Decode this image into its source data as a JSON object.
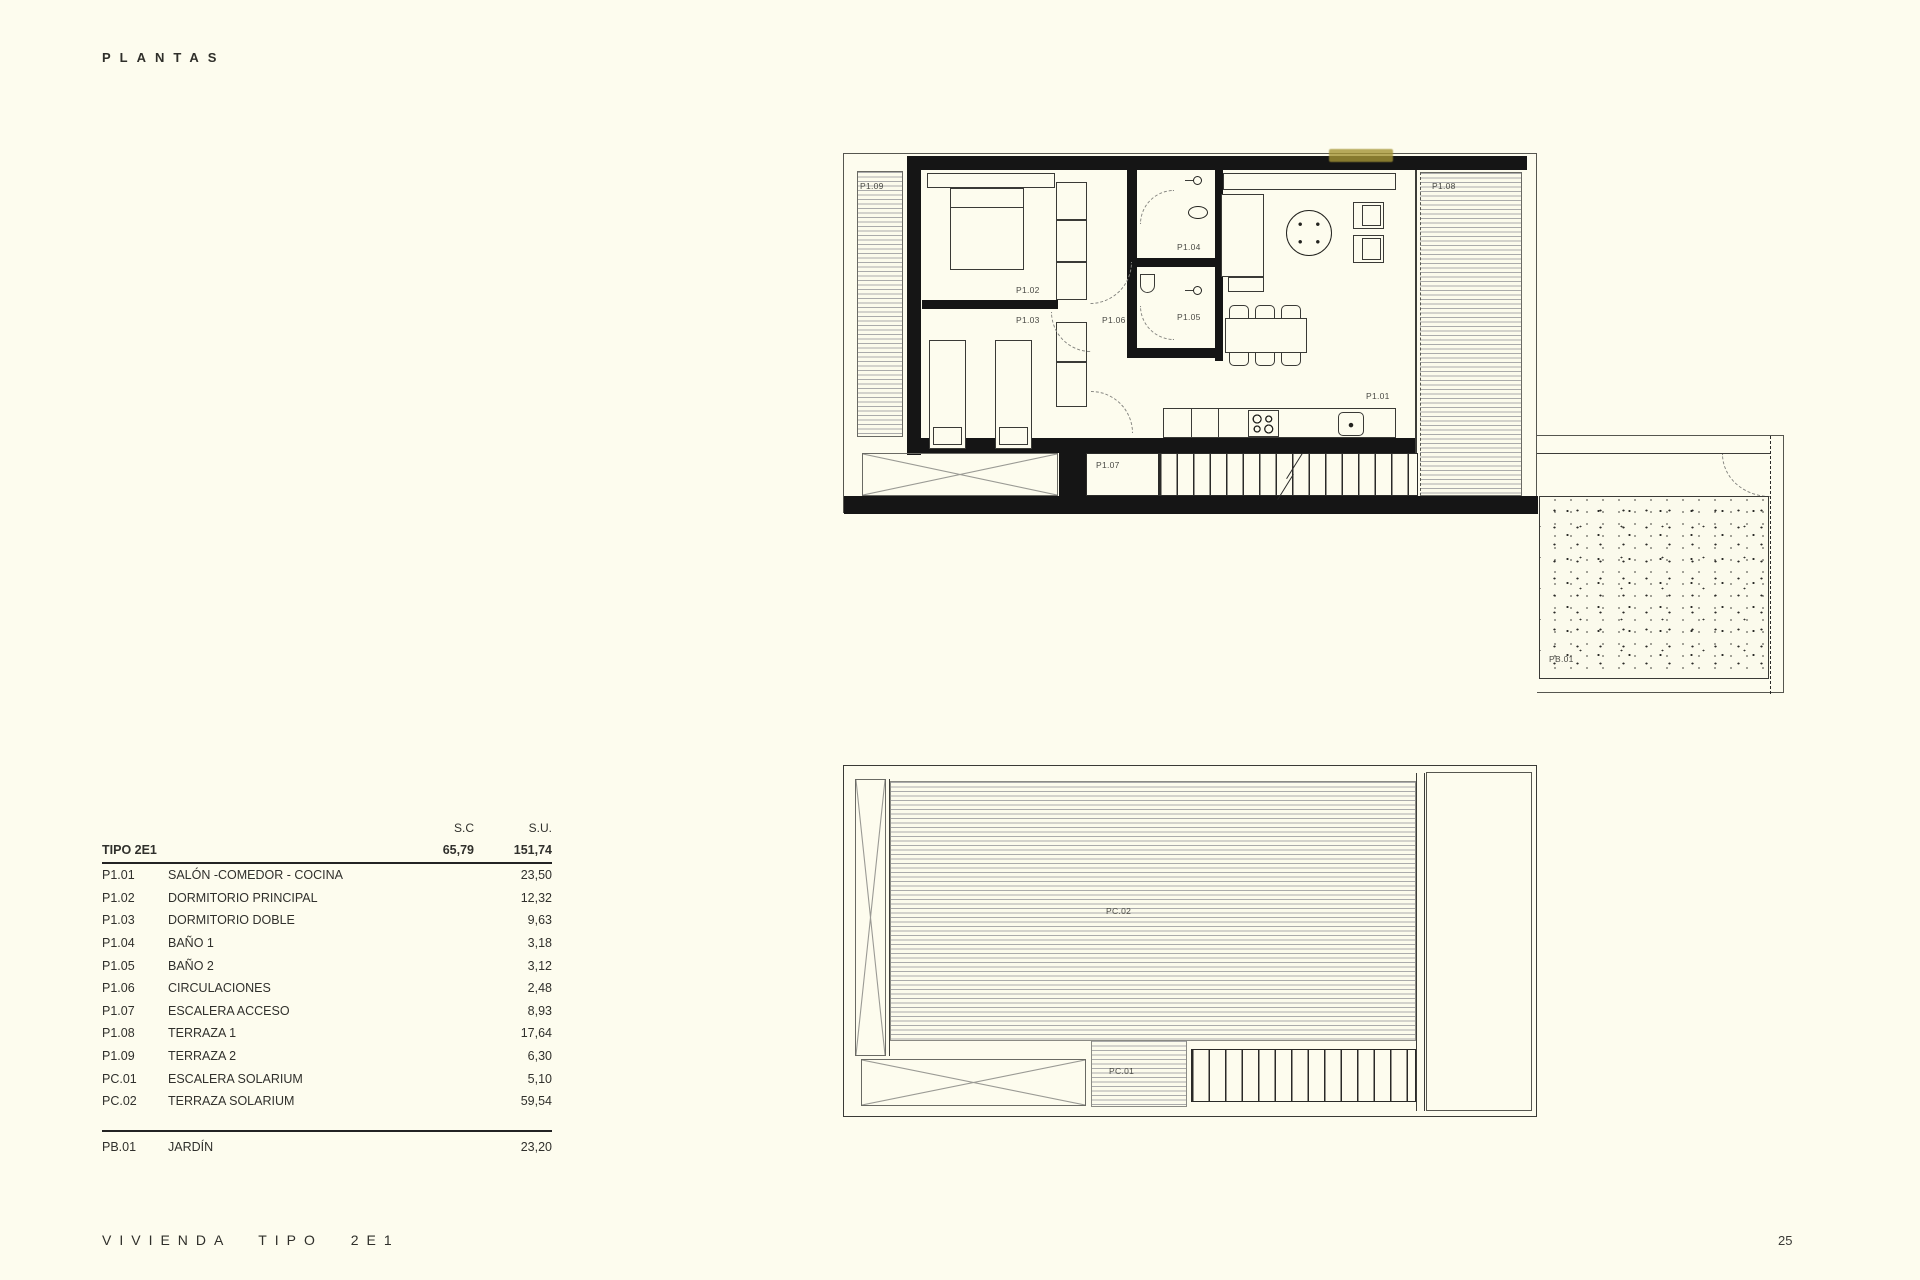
{
  "page": {
    "title": "PLANTAS",
    "footer": "VIVIENDA TIPO 2E1",
    "page_number": "25"
  },
  "colors": {
    "background": "#fdfcee",
    "wall_ink": "#151515",
    "hatch_line": "#ababab",
    "label_ink": "#4a4a45",
    "artifact_yellow": "#a49434"
  },
  "table": {
    "col_headers": {
      "sc": "S.C",
      "su": "S.U."
    },
    "group": {
      "name": "TIPO 2E1",
      "sc": "65,79",
      "su": "151,74"
    },
    "rows": [
      {
        "code": "P1.01",
        "name": "SALÓN -COMEDOR - COCINA",
        "su": "23,50"
      },
      {
        "code": "P1.02",
        "name": "DORMITORIO PRINCIPAL",
        "su": "12,32"
      },
      {
        "code": "P1.03",
        "name": "DORMITORIO DOBLE",
        "su": "9,63"
      },
      {
        "code": "P1.04",
        "name": "BAÑO 1",
        "su": "3,18"
      },
      {
        "code": "P1.05",
        "name": "BAÑO 2",
        "su": "3,12"
      },
      {
        "code": "P1.06",
        "name": "CIRCULACIONES",
        "su": "2,48"
      },
      {
        "code": "P1.07",
        "name": "ESCALERA ACCESO",
        "su": "8,93"
      },
      {
        "code": "P1.08",
        "name": "TERRAZA 1",
        "su": "17,64"
      },
      {
        "code": "P1.09",
        "name": "TERRAZA 2",
        "su": "6,30"
      },
      {
        "code": "PC.01",
        "name": "ESCALERA SOLARIUM",
        "su": "5,10"
      },
      {
        "code": "PC.02",
        "name": "TERRAZA SOLARIUM",
        "su": "59,54"
      }
    ],
    "extra_row": {
      "code": "PB.01",
      "name": "JARDÍN",
      "su": "23,20"
    }
  },
  "plan_first": {
    "labels": {
      "p101": "P1.01",
      "p102": "P1.02",
      "p103": "P1.03",
      "p104": "P1.04",
      "p105": "P1.05",
      "p106": "P1.06",
      "p107": "P1.07",
      "p108": "P1.08",
      "p109": "P1.09",
      "pb01": "PB.01"
    }
  },
  "plan_roof": {
    "labels": {
      "pc01": "PC.01",
      "pc02": "PC.02"
    }
  }
}
